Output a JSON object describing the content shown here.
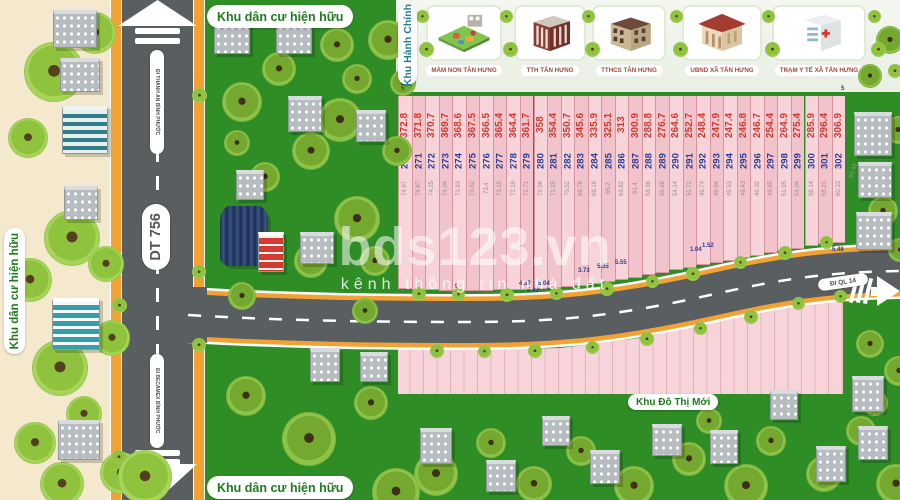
{
  "map": {
    "watermark": {
      "brand": "bds123.vn",
      "tagline": "kênh thông tin nhà đất"
    },
    "zones": {
      "residential_top": "Khu dân cư hiện hữu",
      "residential_left": "Khu dân cư hiện hữu",
      "residential_bottom": "Khu dân cư hiện hữu",
      "admin": "Khu Hành Chính",
      "new_urban": "Khu Đô Thị Mới"
    },
    "roads": {
      "main_road": "DT 756",
      "dir_north": "ĐI THANH AN BÌNH PHƯỚC",
      "dir_south": "ĐI BECAMEX BÌNH PHƯỚC",
      "dir_east": "ĐI QL 14"
    },
    "admin_buildings": [
      {
        "label": "MẦM NON TÂN HƯNG",
        "icon": "kindergarten-icon"
      },
      {
        "label": "TTH TÂN HƯNG",
        "icon": "school-icon"
      },
      {
        "label": "TTHCS TÂN HƯNG",
        "icon": "secondary-school-icon"
      },
      {
        "label": "UBND XÃ TÂN HƯNG",
        "icon": "town-hall-icon"
      },
      {
        "label": "TRẠM Y TẾ XÃ TÂN HƯNG",
        "icon": "health-station-icon"
      }
    ],
    "plots": [
      {
        "no": "270",
        "area": "372.8",
        "frontage": "74.67"
      },
      {
        "no": "271",
        "area": "371.8",
        "frontage": "74.67"
      },
      {
        "no": "272",
        "area": "370.7",
        "frontage": "74.25"
      },
      {
        "no": "273",
        "area": "369.7",
        "frontage": "74.04"
      },
      {
        "no": "274",
        "area": "368.6",
        "frontage": "73.83"
      },
      {
        "no": "275",
        "area": "367.5",
        "frontage": "73.62"
      },
      {
        "no": "276",
        "area": "366.5",
        "frontage": "73.4"
      },
      {
        "no": "277",
        "area": "365.4",
        "frontage": "73.19"
      },
      {
        "no": "278",
        "area": "364.4",
        "frontage": "72.19"
      },
      {
        "no": "279",
        "area": "361.7",
        "frontage": "72.71"
      },
      {
        "no": "280",
        "area": "358",
        "frontage": "72.98"
      },
      {
        "no": "281",
        "area": "354.4",
        "frontage": "71.25"
      },
      {
        "no": "282",
        "area": "350.7",
        "frontage": "70.52"
      },
      {
        "no": "283",
        "area": "345.6",
        "frontage": "69.78"
      },
      {
        "no": "284",
        "area": "335.9",
        "frontage": "68.18"
      },
      {
        "no": "285",
        "area": "325.1",
        "frontage": "66.2"
      },
      {
        "no": "286",
        "area": "313",
        "frontage": "63.82"
      },
      {
        "no": "287",
        "area": "300.9",
        "frontage": "61.4"
      },
      {
        "no": "288",
        "area": "288.8",
        "frontage": "58.96"
      },
      {
        "no": "289",
        "area": "276.7",
        "frontage": "56.98"
      },
      {
        "no": "290",
        "area": "264.6",
        "frontage": "54.14"
      },
      {
        "no": "291",
        "area": "252.7",
        "frontage": "51.72"
      },
      {
        "no": "292",
        "area": "248.4",
        "frontage": "49.74"
      },
      {
        "no": "293",
        "area": "247.9",
        "frontage": "49.64"
      },
      {
        "no": "294",
        "area": "247.4",
        "frontage": "49.53"
      },
      {
        "no": "295",
        "area": "246.8",
        "frontage": "49.43"
      },
      {
        "no": "296",
        "area": "246.7",
        "frontage": "49.32"
      },
      {
        "no": "297",
        "area": "254.4",
        "frontage": "49.85"
      },
      {
        "no": "298",
        "area": "264.9",
        "frontage": "51.95"
      },
      {
        "no": "299",
        "area": "275.4",
        "frontage": "54.04"
      },
      {
        "no": "300",
        "area": "285.9",
        "frontage": "56.14"
      },
      {
        "no": "301",
        "area": "296.4",
        "frontage": "58.23"
      },
      {
        "no": "302",
        "area": "306.9",
        "frontage": "60.33"
      }
    ],
    "dimensions": [
      {
        "value": "5",
        "x": 401,
        "y": 86,
        "rotate": 0
      },
      {
        "value": "5",
        "x": 841,
        "y": 86,
        "rotate": 0
      },
      {
        "value": "5",
        "x": 455,
        "y": 284,
        "rotate": 0
      },
      {
        "value": "4.37",
        "x": 519,
        "y": 281,
        "rotate": 0
      },
      {
        "value": "5.04",
        "x": 538,
        "y": 281,
        "rotate": 0
      },
      {
        "value": "5.43",
        "x": 527,
        "y": 288,
        "rotate": 0
      },
      {
        "value": "3.73",
        "x": 578,
        "y": 268,
        "rotate": 0
      },
      {
        "value": "5.35",
        "x": 597,
        "y": 264,
        "rotate": 0
      },
      {
        "value": "5.55",
        "x": 615,
        "y": 260,
        "rotate": 0
      },
      {
        "value": "1.04",
        "x": 690,
        "y": 247,
        "rotate": 0
      },
      {
        "value": "1.52",
        "x": 702,
        "y": 243,
        "rotate": 0
      },
      {
        "value": "5.48",
        "x": 832,
        "y": 247,
        "rotate": 0
      },
      {
        "value": "62.43",
        "x": 846,
        "y": 168,
        "rotate": -72
      }
    ],
    "colors": {
      "grass": "#2f8d26",
      "sand": "#f4e9cc",
      "asphalt": "#595e61",
      "sidewalk": "#f2a233",
      "plot_pink": "#f6d4d9",
      "plot_pink_alt": "#f1c3cb",
      "plot_border": "#d9939e",
      "area_text": "#cf3a30",
      "plot_no_text": "#2b3c92",
      "frontage_text": "#9b9089",
      "zone_label": "#1f7a1f",
      "admin_label": "#1e7f8e",
      "card_label": "#a0493b"
    }
  }
}
